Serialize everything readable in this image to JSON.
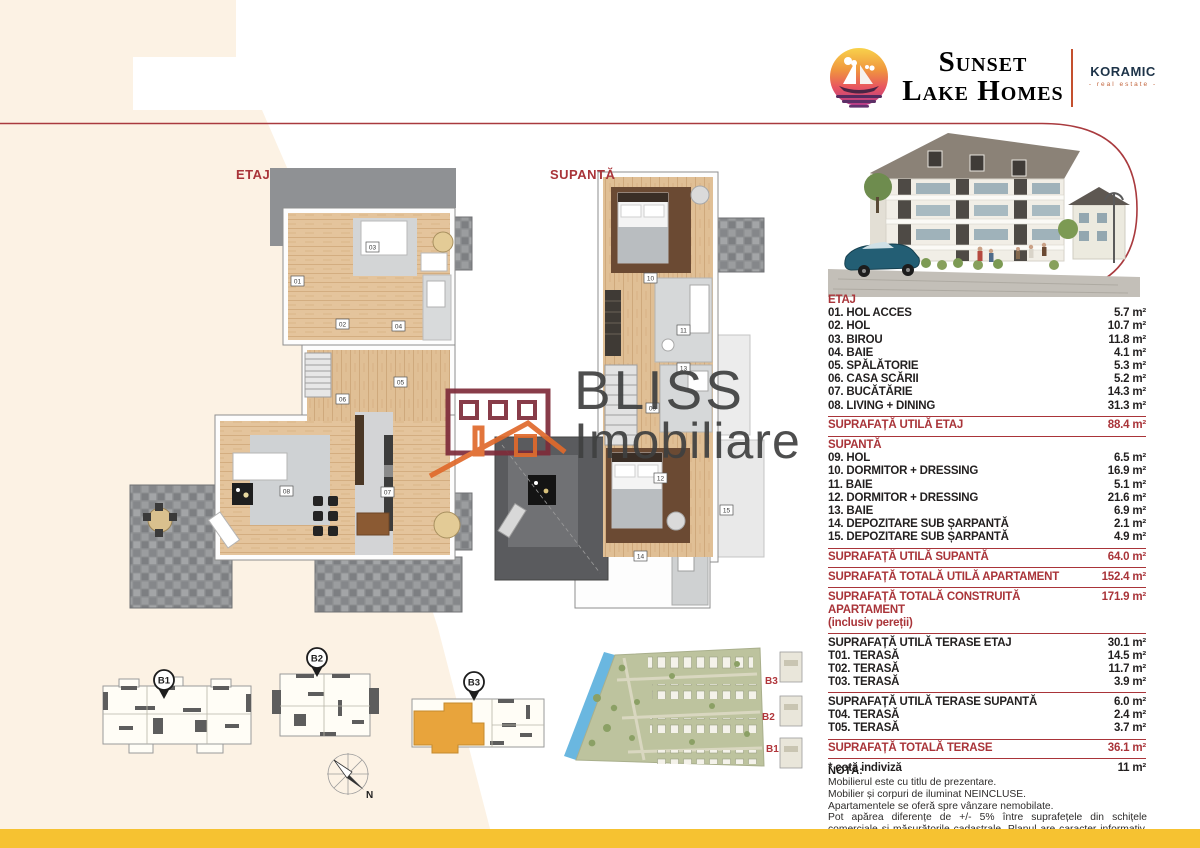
{
  "brand": {
    "name_line1": "Sunset",
    "name_line2": "Lake Homes",
    "partner_name": "KORAMIC",
    "partner_tagline": "- real estate -"
  },
  "colors": {
    "accent_red": "#a93439",
    "cream_bg": "#fcf2e4",
    "footer_yellow": "#f6c231",
    "highlight_orange": "#e8a43c",
    "water_blue": "#6ab7e0",
    "brand_navy": "#1d3348",
    "tagline_orange": "#c2643c"
  },
  "plan_sections": {
    "etaj_label": "ETAJ",
    "supanta_label": "SUPANTĂ",
    "etaj_markers": [
      "01",
      "02",
      "03",
      "04",
      "05",
      "06",
      "07",
      "08"
    ],
    "supanta_markers": [
      "09",
      "10",
      "11",
      "12",
      "13",
      "14",
      "15"
    ]
  },
  "area_table": {
    "etaj": {
      "header": "ETAJ",
      "rows": [
        {
          "label": "01. HOL ACCES",
          "value": "5.7 m²"
        },
        {
          "label": "02. HOL",
          "value": "10.7 m²"
        },
        {
          "label": "03. BIROU",
          "value": "11.8 m²"
        },
        {
          "label": "04. BAIE",
          "value": "4.1 m²"
        },
        {
          "label": "05. SPĂLĂTORIE",
          "value": "5.3 m²"
        },
        {
          "label": "06. CASA SCĂRII",
          "value": "5.2 m²"
        },
        {
          "label": "07. BUCĂTĂRIE",
          "value": "14.3 m²"
        },
        {
          "label": "08. LIVING + DINING",
          "value": "31.3 m²"
        }
      ],
      "total_label": "SUPRAFAȚĂ UTILĂ ETAJ",
      "total_value": "88.4 m²"
    },
    "supanta": {
      "header": "SUPANTĂ",
      "rows": [
        {
          "label": "09. HOL",
          "value": "6.5 m²"
        },
        {
          "label": "10. DORMITOR + DRESSING",
          "value": "16.9 m²"
        },
        {
          "label": "11. BAIE",
          "value": "5.1 m²"
        },
        {
          "label": "12. DORMITOR + DRESSING",
          "value": "21.6 m²"
        },
        {
          "label": "13. BAIE",
          "value": "6.9 m²"
        },
        {
          "label": "14. DEPOZITARE SUB ȘARPANTĂ",
          "value": "2.1 m²"
        },
        {
          "label": "15. DEPOZITARE SUB ȘARPANTĂ",
          "value": "4.9 m²"
        }
      ],
      "total_label": "SUPRAFAȚĂ UTILĂ SUPANTĂ",
      "total_value": "64.0 m²"
    },
    "total_util": {
      "label": "SUPRAFAȚĂ TOTALĂ UTILĂ APARTAMENT",
      "value": "152.4 m²"
    },
    "total_construit": {
      "label": "SUPRAFAȚĂ TOTALĂ CONSTRUITĂ APARTAMENT",
      "sublabel": "(inclusiv pereții)",
      "value": "171.9 m²"
    },
    "terase_etaj": {
      "header_label": "SUPRAFAȚĂ UTILĂ TERASE ETAJ",
      "header_value": "30.1 m²",
      "rows": [
        {
          "label": "T01. TERASĂ",
          "value": "14.5 m²"
        },
        {
          "label": "T02. TERASĂ",
          "value": "11.7 m²"
        },
        {
          "label": "T03. TERASĂ",
          "value": "3.9 m²"
        }
      ]
    },
    "terase_supanta": {
      "header_label": "SUPRAFAȚĂ UTILĂ TERASE SUPANTĂ",
      "header_value": "6.0 m²",
      "rows": [
        {
          "label": "T04. TERASĂ",
          "value": "2.4 m²"
        },
        {
          "label": "T05. TERASĂ",
          "value": "3.7 m²"
        }
      ]
    },
    "terase_total": {
      "label": "SUPRAFAȚĂ TOTALĂ TERASE",
      "value": "36.1 m²"
    },
    "cota_indiviza": {
      "label": "* cotă indiviză",
      "value": "11 m²"
    }
  },
  "note": {
    "title": "NOTĂ:",
    "line1": "Mobilierul este cu titlu de prezentare.",
    "line2": "Mobilier și corpuri de iluminat NEINCLUSE.",
    "line3": "Apartamentele se oferă spre vânzare nemobilate.",
    "paragraph": "Pot apărea diferențe de +/- 5% între suprafețele din schițele comerciale și măsurătorile cadastrale. Planul are caracter informativ, fiind supus eventualelor modificări de natură tehnică sau urbanistică și nu constituie o obligație fermă asumată de către Sunset Lake Homes. Planul de informare supus modificărilor tehnice sau reglementărilor urbane nu constituie un document contractual."
  },
  "overview": {
    "pin_b1": "B1",
    "pin_b2": "B2",
    "pin_b3": "B3",
    "site_label_b3": "B3",
    "site_label_b2": "B2",
    "site_label_b1": "B1",
    "compass_label": "N"
  },
  "watermark": {
    "line1": "BLISS",
    "line2": "Imobiliare"
  }
}
